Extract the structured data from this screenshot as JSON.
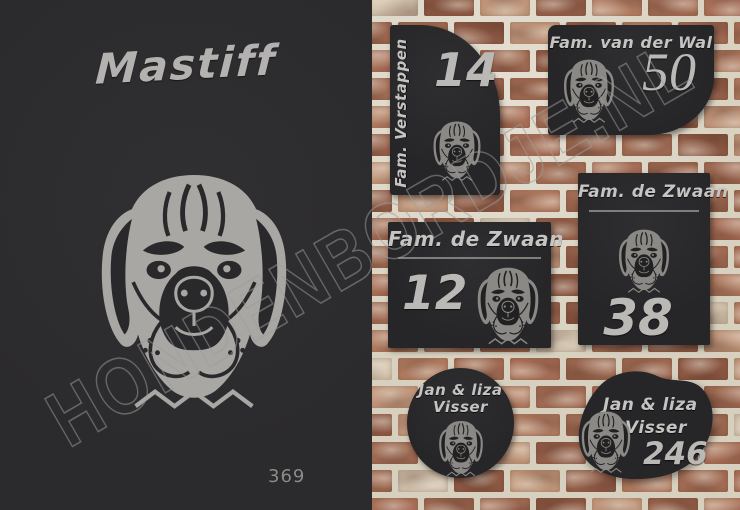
{
  "left_panel": {
    "breed_title": "Mastiff",
    "design_number": "369"
  },
  "plates": [
    {
      "shape": "flag-rounded-top-right",
      "family_name": "Fam. Verstappen",
      "house_number": "14"
    },
    {
      "shape": "rounded-bottom-right",
      "family_name": "Fam. van der Wal",
      "house_number": "50"
    },
    {
      "shape": "rectangle-landscape",
      "family_name": "Fam. de Zwaan",
      "house_number": "12"
    },
    {
      "shape": "rectangle-portrait",
      "family_name": "Fam. de Zwaan",
      "house_number": "38"
    },
    {
      "shape": "circle",
      "name_line1": "Jan & liza",
      "name_line2": "Visser"
    },
    {
      "shape": "blob",
      "name_line1": "Jan & liza",
      "name_line2": "Visser",
      "house_number": "246"
    }
  ],
  "watermark_text": "HONDENBORDJE.NL",
  "icons": {
    "dog": "mastiff-head-icon"
  },
  "colors": {
    "panel_bg": "#2b2a2c",
    "plate_bg": "#262527",
    "engraving_gray": "#b5b3b0",
    "mortar": "#d8d0be",
    "brick_pale": "#d2c3ad",
    "brick_palette": [
      "#a06b53",
      "#96614b",
      "#aa7159",
      "#8e5a45",
      "#b27d62",
      "#9c6850",
      "#c2987c",
      "#a46e56"
    ],
    "watermark_gray": "#9c9c9c"
  }
}
